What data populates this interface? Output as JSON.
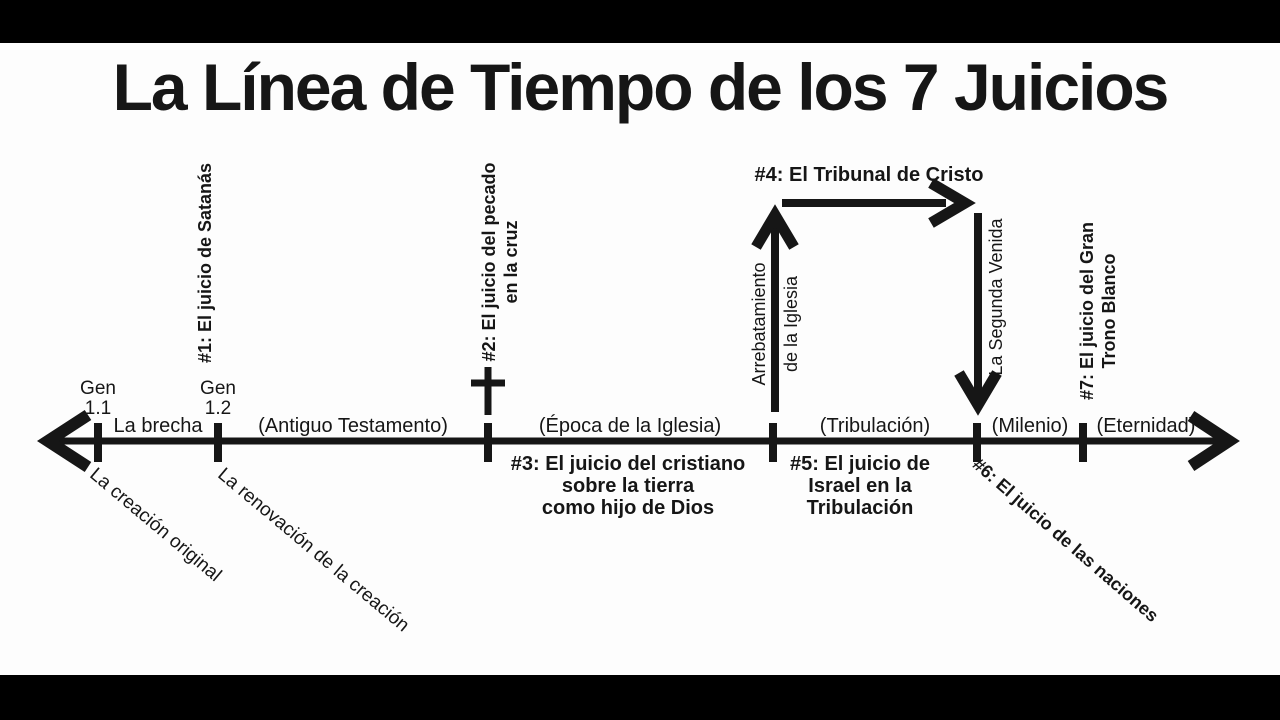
{
  "title": "La Línea de Tiempo de los 7 Juicios",
  "markers": {
    "gen_1_1": "Gen\n1.1",
    "gen_1_2": "Gen\n1.2"
  },
  "segments": {
    "brecha": "La brecha",
    "antiguo_testamento": "(Antiguo Testamento)",
    "epoca_iglesia": "(Época de la Iglesia)",
    "tribulacion": "(Tribulación)",
    "milenio": "(Milenio)",
    "eternidad": "(Eternidad)"
  },
  "judgments": {
    "j1": "#1: El juicio de Satanás",
    "j2": "#2: El juicio del pecado\nen la cruz",
    "j3": "#3: El juicio del cristiano\nsobre la tierra\ncomo hijo de Dios",
    "j4": "#4: El Tribunal de Cristo",
    "j5": "#5: El juicio de\nIsrael en la\nTribulación",
    "j6": "#6: El juicio de las naciones",
    "j7": "#7: El juicio del Gran\nTrono Blanco"
  },
  "events": {
    "rapture_line1": "Arrebatamiento",
    "rapture_line2": "de la Iglesia",
    "second_coming": "La Segunda Venida"
  },
  "annotations": {
    "original_creation": "La creación original",
    "renewal_creation": "La renovación de la creación"
  },
  "colors": {
    "ink": "#161616",
    "background": "#fdfdfd",
    "letterbox": "#000000"
  }
}
